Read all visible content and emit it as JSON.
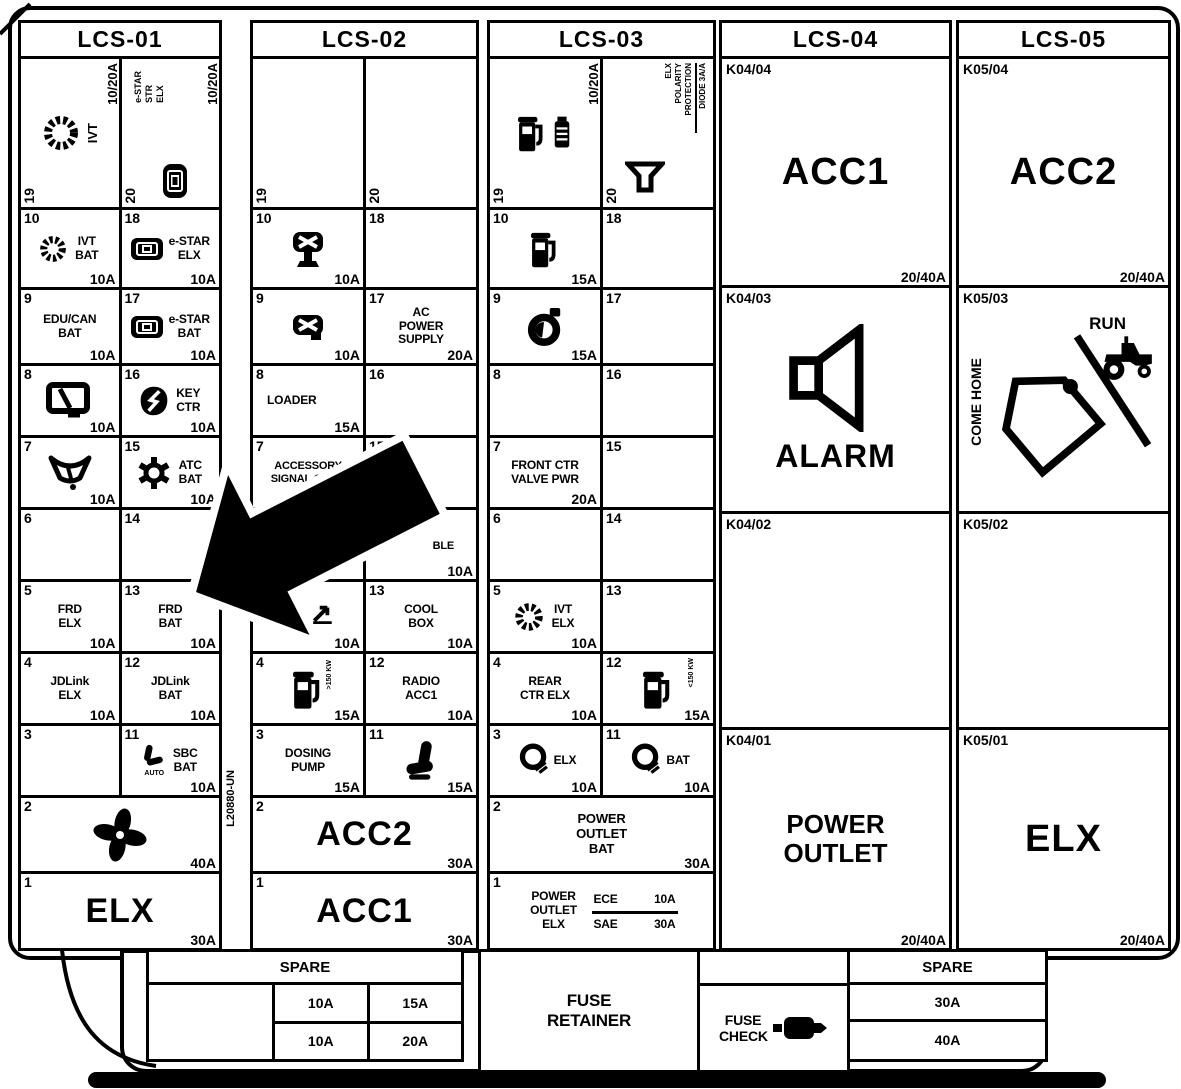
{
  "frame": {
    "side_label": "L20880-UN"
  },
  "lcs01": {
    "title": "LCS-01",
    "c19": {
      "num": "19",
      "label": "IVT",
      "amp": "10/20A"
    },
    "c20": {
      "num": "20",
      "t1": "e-STAR",
      "t2": "STR",
      "t3": "ELX",
      "amp": "10/20A"
    },
    "c10": {
      "num": "10",
      "label": "IVT BAT",
      "amp": "10A"
    },
    "c18": {
      "num": "18",
      "label": "e-STAR ELX",
      "amp": "10A"
    },
    "c9": {
      "num": "9",
      "label": "EDU/CAN BAT",
      "amp": "10A"
    },
    "c17": {
      "num": "17",
      "label": "e-STAR BAT",
      "amp": "10A"
    },
    "c8": {
      "num": "8",
      "amp": "10A"
    },
    "c16": {
      "num": "16",
      "label": "KEY CTR",
      "amp": "10A"
    },
    "c7": {
      "num": "7",
      "amp": "10A"
    },
    "c15": {
      "num": "15",
      "label": "ATC BAT",
      "amp": "10A"
    },
    "c6": {
      "num": "6"
    },
    "c14": {
      "num": "14"
    },
    "c5": {
      "num": "5",
      "label": "FRD ELX",
      "amp": "10A"
    },
    "c13": {
      "num": "13",
      "label": "FRD BAT",
      "amp": "10A"
    },
    "c4": {
      "num": "4",
      "label": "JDLink ELX",
      "amp": "10A"
    },
    "c12": {
      "num": "12",
      "label": "JDLink BAT",
      "amp": "10A"
    },
    "c3": {
      "num": "3"
    },
    "c11": {
      "num": "11",
      "label": "SBC BAT",
      "amp": "10A",
      "icon_text": "AUTO"
    },
    "c2": {
      "num": "2",
      "amp": "40A"
    },
    "c1": {
      "num": "1",
      "label": "ELX",
      "amp": "30A"
    }
  },
  "lcs02": {
    "title": "LCS-02",
    "c19": {
      "num": "19"
    },
    "c20": {
      "num": "20"
    },
    "c10": {
      "num": "10",
      "amp": "10A"
    },
    "c18": {
      "num": "18"
    },
    "c9": {
      "num": "9",
      "amp": "10A"
    },
    "c17": {
      "num": "17",
      "label": "AC POWER SUPPLY",
      "amp": "20A"
    },
    "c8": {
      "num": "8",
      "label": "LOADER",
      "amp": "15A"
    },
    "c16": {
      "num": "16"
    },
    "c7": {
      "num": "7",
      "label": "ACCESSORY SIGNAL CONN"
    },
    "c15": {
      "num": "15"
    },
    "c6": {
      "num": "6"
    },
    "c14": {
      "num": "14",
      "label": "BLE",
      "amp": "10A"
    },
    "c5": {
      "num": "5",
      "amp": "10A"
    },
    "c13": {
      "num": "13",
      "label": "COOL BOX",
      "amp": "10A"
    },
    "c4": {
      "num": "4",
      "note": ">150 KW",
      "amp": "15A"
    },
    "c12": {
      "num": "12",
      "label": "RADIO ACC1",
      "amp": "10A"
    },
    "c3": {
      "num": "3",
      "label": "DOSING PUMP",
      "amp": "15A"
    },
    "c11": {
      "num": "11",
      "amp": "15A"
    },
    "c2": {
      "num": "2",
      "label": "ACC2",
      "amp": "30A"
    },
    "c1": {
      "num": "1",
      "label": "ACC1",
      "amp": "30A"
    }
  },
  "lcs03": {
    "title": "LCS-03",
    "c19": {
      "num": "19",
      "amp": "10/20A"
    },
    "c20": {
      "num": "20",
      "t1": "ELX",
      "t2": "POLARITY",
      "t3": "PROTECTION",
      "t4": "DIODE 3A/A"
    },
    "c10": {
      "num": "10",
      "amp": "15A"
    },
    "c18": {
      "num": "18"
    },
    "c9": {
      "num": "9",
      "amp": "15A"
    },
    "c17": {
      "num": "17"
    },
    "c8": {
      "num": "8"
    },
    "c16": {
      "num": "16"
    },
    "c7": {
      "num": "7",
      "label": "FRONT CTR VALVE PWR",
      "amp": "20A"
    },
    "c15": {
      "num": "15"
    },
    "c6": {
      "num": "6"
    },
    "c14": {
      "num": "14"
    },
    "c5": {
      "num": "5",
      "label": "IVT ELX",
      "amp": "10A"
    },
    "c13": {
      "num": "13"
    },
    "c4": {
      "num": "4",
      "label": "REAR CTR ELX",
      "amp": "10A"
    },
    "c12": {
      "num": "12",
      "note": "<150 KW",
      "amp": "15A"
    },
    "c3": {
      "num": "3",
      "label": "ELX",
      "amp": "10A"
    },
    "c11": {
      "num": "11",
      "label": "BAT",
      "amp": "10A"
    },
    "c2": {
      "num": "2",
      "label": "POWER OUTLET BAT",
      "amp": "30A"
    },
    "c1": {
      "num": "1",
      "label": "POWER OUTLET ELX",
      "r1l": "ECE",
      "r1a": "10A",
      "r2l": "SAE",
      "r2a": "30A"
    }
  },
  "lcs04": {
    "title": "LCS-04",
    "k4": {
      "num": "K04/04",
      "label": "ACC1",
      "amp": "20/40A"
    },
    "k3": {
      "num": "K04/03",
      "label": "ALARM"
    },
    "k2": {
      "num": "K04/02"
    },
    "k1": {
      "num": "K04/01",
      "label": "POWER OUTLET",
      "amp": "20/40A"
    }
  },
  "lcs05": {
    "title": "LCS-05",
    "k4": {
      "num": "K05/04",
      "label": "ACC2",
      "amp": "20/40A"
    },
    "k3": {
      "num": "K05/03",
      "come_home": "COME HOME",
      "run": "RUN"
    },
    "k2": {
      "num": "K05/02"
    },
    "k1": {
      "num": "K05/01",
      "label": "ELX",
      "amp": "20/40A"
    }
  },
  "bottom": {
    "spare_left": {
      "title": "SPARE",
      "r1c1": "10A",
      "r1c2": "15A",
      "r2c1": "10A",
      "r2c2": "20A"
    },
    "fuse_retainer": "FUSE RETAINER",
    "fuse_check": "FUSE CHECK",
    "spare_right": {
      "title": "SPARE",
      "r1": "30A",
      "r2": "40A"
    }
  }
}
